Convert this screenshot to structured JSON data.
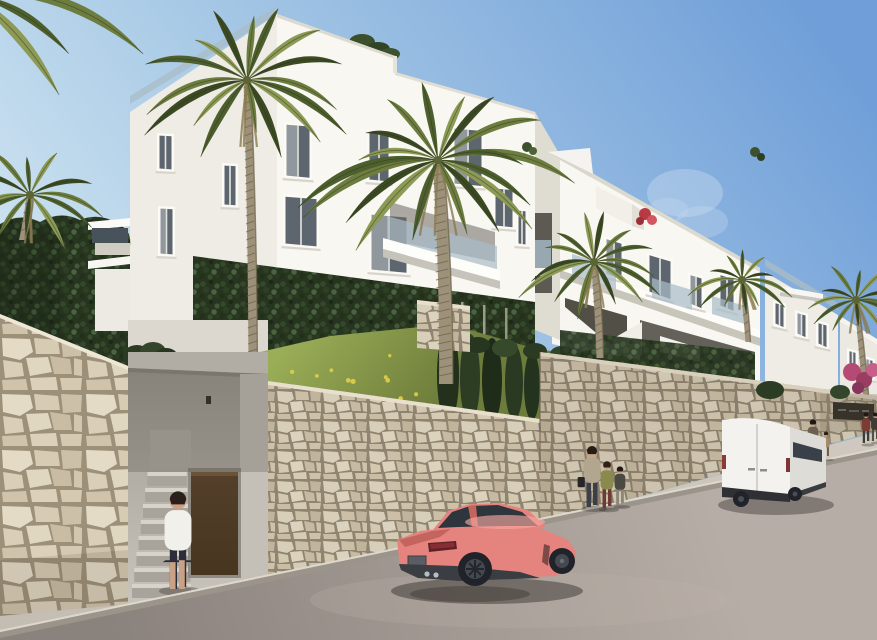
{
  "scene": {
    "type": "architectural-exterior-render",
    "setting": "modern white apartment complex on a hillside street",
    "time_of_day": "daytime",
    "weather": "clear blue sky with faint cloud wisp",
    "elements": [
      "stepped white apartment building with balconies and glass railings",
      "palm trees in front of facade",
      "green vine-covered ground floor wall",
      "dark clipped hedge on left",
      "grass slope with small yellow flowers",
      "beige natural stone retaining walls along street",
      "pedestrian entrance alcove with stairs and brown door",
      "woman walking up entrance stairs",
      "coral sports coupe parked on street",
      "white panel van parked at right curb",
      "woman with two children on sidewalk",
      "man and child walking near van",
      "distant group of people at complex entrance",
      "dark entrance sign embedded in stone wall (text illegible)",
      "magenta bougainvillea at far right"
    ]
  },
  "palette": {
    "sky-top": "#6f9ed8",
    "sky-mid": "#a9cae6",
    "sky-low": "#ddeef5",
    "building-lit": "#f8f7f2",
    "building-shade": "#eeece5",
    "building-dark": "#dfdcd2",
    "window-glass": "#5d666e",
    "rail-glass": "#a9bcc7",
    "vine-green": "#263420",
    "hedge-green": "#2b3a24",
    "palm-green-1": "#6d7d3f",
    "palm-green-2": "#4e5f2e",
    "palm-green-3": "#8c9a55",
    "trunk-brown": "#9d9179",
    "stone-gap": "#9c9078",
    "concrete": "#b6b2a9",
    "door-brown": "#46351f",
    "grass-light": "#9aad57",
    "grass-dark": "#6d7c3a",
    "flower-yellow": "#e0cf4a",
    "road-light": "#b6ada6",
    "road-dark": "#8a827c",
    "sidewalk": "#cfc8be",
    "curb": "#9b948a",
    "car-coral": "#e5847e",
    "car-coral-dark": "#c4645f",
    "car-coral-light": "#f4a89f",
    "car-glass": "#2f353c",
    "wheel-dark": "#202329",
    "van-white": "#f3f2ee",
    "van-shade": "#dedcd6",
    "van-bumper": "#2e3034",
    "sign-dark": "#37332b",
    "bougainvillea": "#b54a74",
    "skin": "#caa184"
  }
}
